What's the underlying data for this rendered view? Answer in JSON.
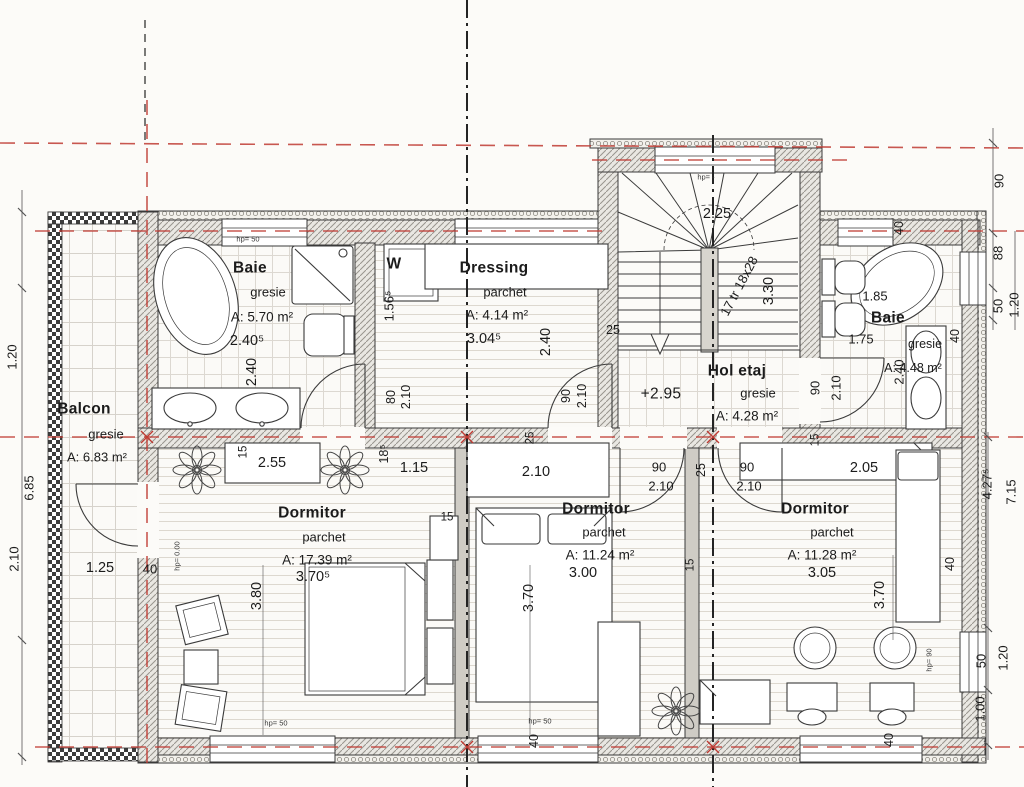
{
  "page": {
    "background": "#fcfbf8",
    "line_color": "#2a2a2a",
    "axis_color": "#c03b33"
  },
  "rooms": {
    "baie_left": {
      "name": "Baie",
      "finish": "gresie",
      "area": "A: 5.70 m²",
      "width": "2.40⁵",
      "depth": "2.40"
    },
    "dressing": {
      "name": "Dressing",
      "finish": "parchet",
      "area": "A: 4.14 m²",
      "width": "3.04⁵",
      "depth": "2.40",
      "niche": "1.56⁵",
      "washer": "W"
    },
    "hol": {
      "name": "Hol etaj",
      "level": "+2.95",
      "finish": "gresie",
      "area": "A: 4.28 m²"
    },
    "baie_right": {
      "name": "Baie",
      "finish": "gresie",
      "area": "A: 4.48 m²",
      "dim_a": "1.85",
      "dim_b": "1.75",
      "depth": "2.40"
    },
    "balcon": {
      "name": "Balcon",
      "finish": "gresie",
      "area": "A: 6.83 m²",
      "dim_a": "1.25",
      "dim_b": "40"
    },
    "dormitor_left": {
      "name": "Dormitor",
      "finish": "parchet",
      "area": "A: 17.39 m²",
      "width": "3.70⁵",
      "depth": "3.80",
      "wardrobe": "2.55",
      "seg_a": "18⁵",
      "seg_b": "1.15"
    },
    "dormitor_mid": {
      "name": "Dormitor",
      "finish": "parchet",
      "area": "A: 11.24 m²",
      "width": "3.00",
      "depth": "3.70",
      "wardrobe": "2.10"
    },
    "dormitor_right": {
      "name": "Dormitor",
      "finish": "parchet",
      "area": "A: 11.28 m²",
      "width": "3.05",
      "depth": "3.70",
      "wardrobe": "2.05",
      "window": "40"
    }
  },
  "stairs": {
    "width": "2.25",
    "treads": "17 tr 18x28",
    "depth": "3.30",
    "wall": "25",
    "parapet": "hp= -"
  },
  "doors": {
    "baie_left": {
      "w": "80",
      "h": "2.10"
    },
    "dressing": {
      "w": "90",
      "h": "2.10"
    },
    "dorm_mid": {
      "w": "90",
      "h": "2.10"
    },
    "dorm_right": {
      "w": "90",
      "h": "2.10"
    },
    "baie_right": {
      "w": "90",
      "h": "2.10"
    }
  },
  "walls": {
    "w25_a": "25",
    "w25_b": "25",
    "w15_a": "15",
    "w15_b": "15",
    "w15_c": "15",
    "w15_d": "15"
  },
  "windows": {
    "baie_right_side": "40",
    "baie_right_top": "40",
    "bottom_mid": "40",
    "bottom_right": "40",
    "sill_top_left": "hp= 50",
    "sill_bottom_a": "hp= 50",
    "sill_bottom_b": "hp= 50",
    "sill_right": "hp= 90",
    "floor_level": "hp= 0.00"
  },
  "edge_dims": {
    "left": [
      "1.20",
      "6.85",
      "2.10"
    ],
    "right_top": [
      "90",
      "88",
      "50",
      "1.20"
    ],
    "right_mid": [
      "4.27⁵",
      "7.15"
    ],
    "right_bottom": [
      "50",
      "1.20",
      "1.00"
    ]
  }
}
